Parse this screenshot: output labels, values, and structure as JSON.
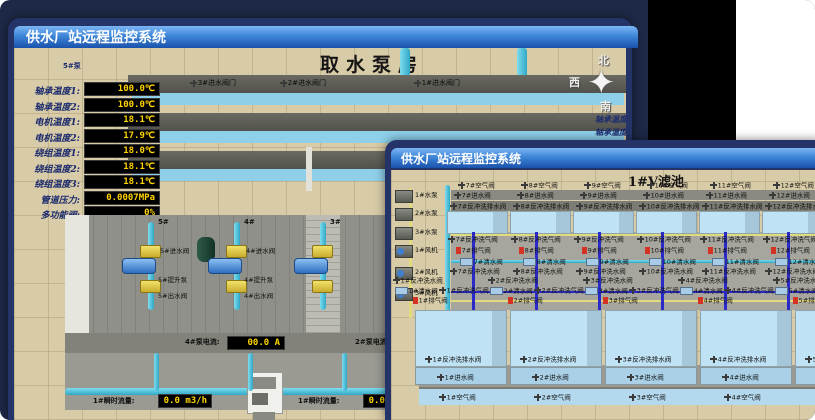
{
  "colors": {
    "desktop": "#1d2946",
    "titlebar_top": "#7cb6f4",
    "titlebar_bottom": "#1a52ab",
    "window_border": "#243468",
    "value_text": "#ffd400",
    "value_bg": "#000000",
    "alarm_red": "#d43222",
    "pipe_cyan": "#2fa8c4",
    "valve_yellow": "#e8d34b",
    "ground_tan": "#d8cba7",
    "pool_blue": "#bfe2f4",
    "pump_blue": "#4a90d9"
  },
  "back_window": {
    "titlebar": "供水厂站远程监控系统",
    "scene_title": "取水泵房",
    "pump_panel": {
      "title": "5#泵",
      "rows": [
        {
          "label": "轴承温度1:",
          "value": "100.0℃"
        },
        {
          "label": "轴承温度2:",
          "value": "100.0℃"
        },
        {
          "label": "电机温度1:",
          "value": "18.1℃"
        },
        {
          "label": "电机温度2:",
          "value": "17.9℃"
        },
        {
          "label": "绕组温度1:",
          "value": "18.0℃"
        },
        {
          "label": "绕组温度2:",
          "value": "18.1℃"
        },
        {
          "label": "绕组温度3:",
          "value": "18.1℃"
        },
        {
          "label": "管道压力:",
          "value": "0.0007MPa"
        },
        {
          "label": "多功能阀:",
          "value": "0%"
        }
      ]
    },
    "right_panel": {
      "title": "1#",
      "rows": [
        {
          "label": "轴承温度1:"
        },
        {
          "label": "轴承温度2:"
        }
      ]
    },
    "compass": {
      "north": "北",
      "west": "西",
      "south": "南"
    },
    "intake_valves": [
      "3#进水阀门",
      "2#进水阀门",
      "1#进水阀门"
    ],
    "pump_columns": [
      {
        "id": "5#",
        "inlet": "5#进水阀",
        "pump": "5#提升泵",
        "outlet": "5#出水阀"
      },
      {
        "id": "4#",
        "inlet": "4#进水阀",
        "pump": "4#提升泵",
        "outlet": "4#出水阀"
      },
      {
        "id": "3#",
        "inlet": "",
        "pump": "",
        "outlet": ""
      }
    ],
    "current_displays": [
      {
        "label": "4#泵电流:",
        "value": "00.0 A"
      },
      {
        "label": "2#泵电流",
        "value": ""
      }
    ],
    "flow_displays": [
      {
        "label": "1#瞬时流量:",
        "value": "0.0 m3/h"
      },
      {
        "label": "1#瞬时流量:",
        "value": "0.0 m3/h"
      }
    ]
  },
  "front_window": {
    "titlebar": "供水厂站远程监控系统",
    "scene_title": "1#V滤池",
    "equipment": [
      "1#水泵",
      "2#水泵",
      "3#水泵",
      "1#风机",
      "2#风机",
      "3#风机"
    ],
    "top_cells": [
      {
        "air": "7#空气阀",
        "inlet": "7#进水阀",
        "drain": "7#反冲洗排水阀",
        "bw_air": "7#反冲洗气阀",
        "exhaust": "7#排气阀",
        "clean": "7#清水阀",
        "bw_water": "7#反冲洗水阀"
      },
      {
        "air": "8#空气阀",
        "inlet": "8#进水阀",
        "drain": "8#反冲洗排水阀",
        "bw_air": "8#反冲洗气阀",
        "exhaust": "8#排气阀",
        "clean": "8#清水阀",
        "bw_water": "8#反冲洗水阀"
      },
      {
        "air": "9#空气阀",
        "inlet": "9#进水阀",
        "drain": "9#反冲洗排水阀",
        "bw_air": "9#反冲洗气阀",
        "exhaust": "9#排气阀",
        "clean": "9#清水阀",
        "bw_water": "9#反冲洗水阀"
      },
      {
        "air": "10#空气阀",
        "inlet": "10#进水阀",
        "drain": "10#反冲洗排水阀",
        "bw_air": "10#反冲洗气阀",
        "exhaust": "10#排气阀",
        "clean": "10#清水阀",
        "bw_water": "10#反冲洗水阀"
      },
      {
        "air": "11#空气阀",
        "inlet": "11#进水阀",
        "drain": "11#反冲洗排水阀",
        "bw_air": "11#反冲洗气阀",
        "exhaust": "11#排气阀",
        "clean": "11#清水阀",
        "bw_water": "11#反冲洗水阀"
      },
      {
        "air": "12#空气阀",
        "inlet": "12#进水阀",
        "drain": "12#反冲洗排水阀",
        "bw_air": "12#反冲洗气阀",
        "exhaust": "12#排气阀",
        "clean": "12#清水阀",
        "bw_water": "12#反冲洗水阀"
      }
    ],
    "bottom_cells": [
      {
        "bw_water": "1#反冲洗水阀",
        "clean": "1#清水阀",
        "bw_air": "1#反冲洗气阀",
        "exhaust": "1#排气阀",
        "drain": "1#反冲洗排水阀",
        "inlet": "1#进水阀",
        "air": "1#空气阀"
      },
      {
        "bw_water": "2#反冲洗水阀",
        "clean": "2#清水阀",
        "bw_air": "2#反冲洗气阀",
        "exhaust": "2#排气阀",
        "drain": "2#反冲洗排水阀",
        "inlet": "2#进水阀",
        "air": "2#空气阀"
      },
      {
        "bw_water": "3#反冲洗水阀",
        "clean": "3#清水阀",
        "bw_air": "3#反冲洗气阀",
        "exhaust": "3#排气阀",
        "drain": "3#反冲洗排水阀",
        "inlet": "3#进水阀",
        "air": "3#空气阀"
      },
      {
        "bw_water": "4#反冲洗水阀",
        "clean": "4#清水阀",
        "bw_air": "4#反冲洗气阀",
        "exhaust": "4#排气阀",
        "drain": "4#反冲洗排水阀",
        "inlet": "4#进水阀",
        "air": "4#空气阀"
      },
      {
        "bw_water": "5#反冲洗水阀",
        "clean": "5#清水阀",
        "bw_air": "5#反冲洗气阀",
        "exhaust": "5#排气阀",
        "drain": "5#反冲洗排水阀",
        "inlet": "5#进水阀",
        "air": "5#空气阀"
      }
    ]
  }
}
